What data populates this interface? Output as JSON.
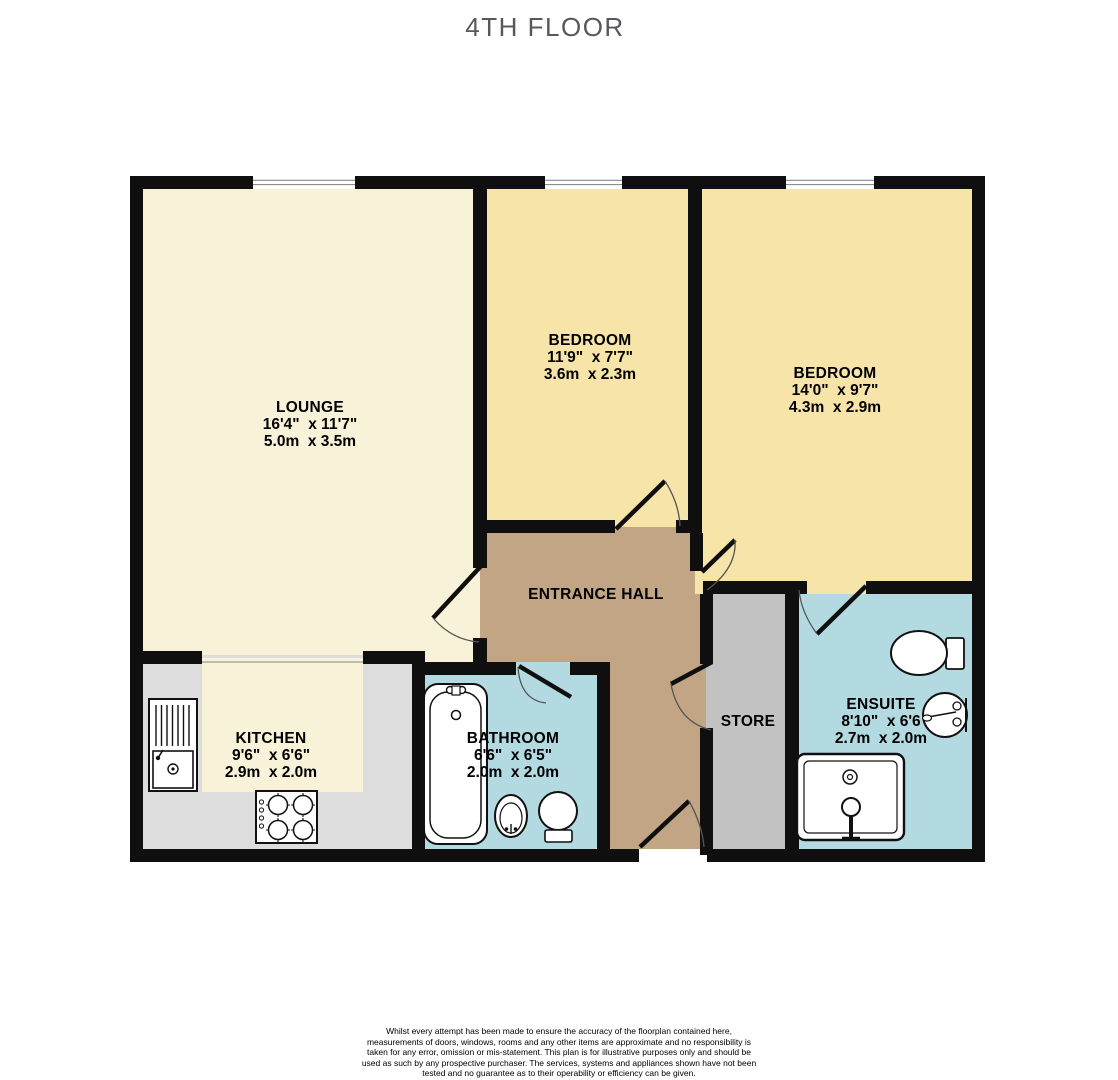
{
  "title": "4TH FLOOR",
  "rooms": {
    "lounge": {
      "name": "LOUNGE",
      "imperial": "16'4\"  x 11'7\"",
      "metric": "5.0m  x 3.5m"
    },
    "bedroom1": {
      "name": "BEDROOM",
      "imperial": "11'9\"  x 7'7\"",
      "metric": "3.6m  x 2.3m"
    },
    "bedroom2": {
      "name": "BEDROOM",
      "imperial": "14'0\"  x 9'7\"",
      "metric": "4.3m  x 2.9m"
    },
    "entrance_hall": {
      "name": "ENTRANCE HALL"
    },
    "kitchen": {
      "name": "KITCHEN",
      "imperial": "9'6\"  x 6'6\"",
      "metric": "2.9m  x 2.0m"
    },
    "bathroom": {
      "name": "BATHROOM",
      "imperial": "6'6\"  x 6'5\"",
      "metric": "2.0m  x 2.0m"
    },
    "store": {
      "name": "STORE"
    },
    "ensuite": {
      "name": "ENSUITE",
      "imperial": "8'10\"  x 6'6",
      "metric": "2.7m  x 2.0m"
    }
  },
  "colors": {
    "wall": "#0f0f0f",
    "cream": "#f8f2d9",
    "bedroom": "#f7e4a9",
    "hall": "#c2a585",
    "bathroom": "#b3d9e1",
    "store": "#c2c2c2",
    "counter": "#dddddd",
    "window_line": "#8c8c8c",
    "door_arc": "#555555",
    "title": "#57585b",
    "text": "#111111"
  },
  "disclaimer": {
    "body": "Whilst every attempt has been made to ensure the accuracy of the floorplan contained here, measurements of doors, windows, rooms and any other items are approximate and no responsibility is taken for any error, omission or mis-statement. This plan is for illustrative purposes only and should be used as such by any prospective purchaser. The services, systems and appliances shown have not been tested and no guarantee as to their operability or efficiency can be given.",
    "credit": "Made with Metropix ©2023"
  }
}
